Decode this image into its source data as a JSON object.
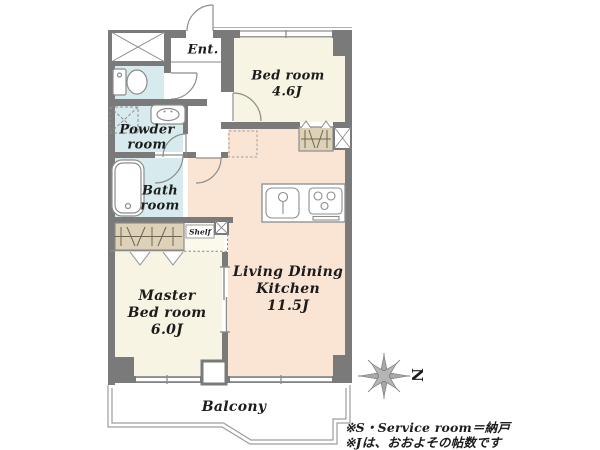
{
  "page": {
    "background": "#ffffff"
  },
  "colors": {
    "wall": "#7a7a7a",
    "line": "#8c8c8c",
    "thin": "#9d9d9d",
    "water": "#d7ebee",
    "cream": "#f7f4e3",
    "peach": "#fae4d4",
    "tan": "#ddd2b8",
    "shelf_floor": "#fbf9ec",
    "ink": "#1c1c1c"
  },
  "rooms": {
    "entrance": {
      "label": "Ent."
    },
    "bedroom": {
      "name": "Bed room",
      "size": "4.6J"
    },
    "powder_room": {
      "name_line1": "Powder",
      "name_line2": "room"
    },
    "bath_room": {
      "name_line1": "Bath",
      "name_line2": "room"
    },
    "master_bedroom": {
      "name_line1": "Master",
      "name_line2": "Bed room",
      "size": "6.0J"
    },
    "ldk": {
      "name_line1": "Living Dining",
      "name_line2": "Kitchen",
      "size": "11.5J"
    },
    "shelf": {
      "label": "Shelf"
    },
    "balcony": {
      "label": "Balcony"
    }
  },
  "compass": {
    "north_label": "N"
  },
  "footnotes": {
    "line1": "※S・Service room＝納戸",
    "line2": "※Jは、おおよその帖数です"
  }
}
